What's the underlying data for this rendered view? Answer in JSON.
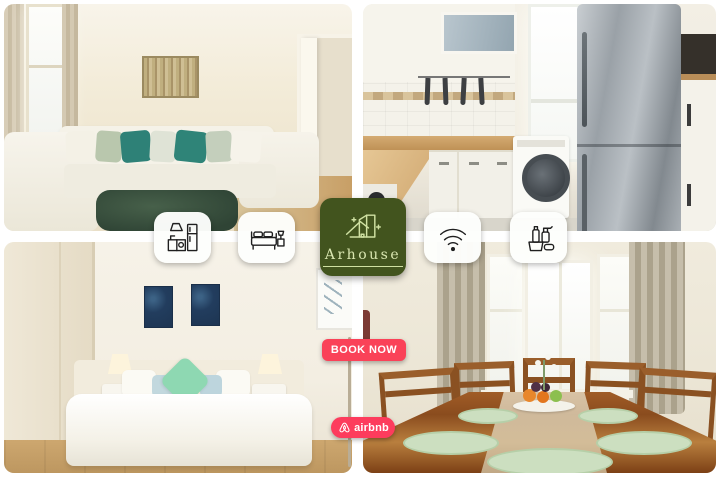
{
  "collage": {
    "brand": {
      "name": "Arhouse"
    },
    "cta": {
      "label": "BOOK NOW"
    },
    "platform": {
      "label": "airbnb"
    },
    "amenity_icons": [
      "kitchen-icon",
      "bed-icon",
      "wifi-icon",
      "cleaning-supplies-icon"
    ],
    "photos": [
      "living-room",
      "kitchen",
      "bedroom",
      "dining-room"
    ],
    "colors": {
      "logo_green": "#42541e",
      "logo_text_green": "#d9e6b0",
      "cta_pink": "#fa4258",
      "airbnb_red": "#fd3c5d",
      "accent_teal": "#2e8177",
      "accent_mint": "#8ed8b2",
      "rug_green": "#2f4435"
    }
  }
}
